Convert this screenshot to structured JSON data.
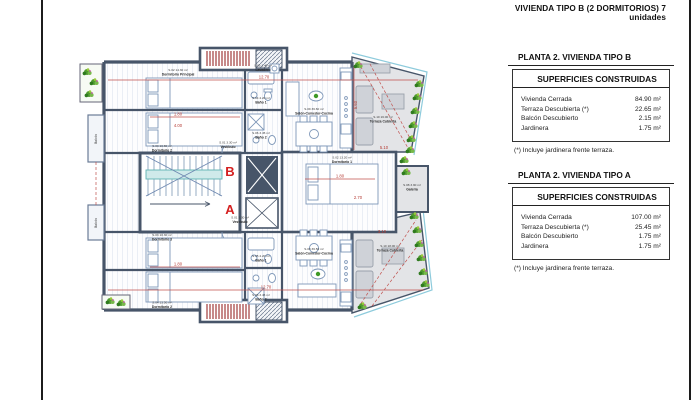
{
  "sheet": {
    "title": "VIVIENDA TIPO B (2 DORMITORIOS) 7 unidades"
  },
  "panels": [
    {
      "heading": "PLANTA 2. VIVIENDA TIPO B",
      "subheading": "SUPERFICIES CONSTRUIDAS",
      "rows": [
        {
          "label": "Vivienda Cerrada",
          "value": "84.90 m²"
        },
        {
          "label": "Terraza Descubierta (*)",
          "value": "22.65 m²"
        },
        {
          "label": "Balcón Descubierto",
          "value": "2.15 m²"
        },
        {
          "label": "Jardinera",
          "value": "1.75 m²"
        }
      ],
      "footnote": "(*) Incluye jardinera frente terraza."
    },
    {
      "heading": "PLANTA 2. VIVIENDA TIPO A",
      "subheading": "SUPERFICIES CONSTRUIDAS",
      "rows": [
        {
          "label": "Vivienda Cerrada",
          "value": "107.00 m²"
        },
        {
          "label": "Terraza Descubierta (*)",
          "value": "25.45 m²"
        },
        {
          "label": "Balcón Descubierto",
          "value": "1.75 m²"
        },
        {
          "label": "Jardinera",
          "value": "1.75 m²"
        }
      ],
      "footnote": "(*) Incluye jardinera frente terraza."
    }
  ],
  "plan": {
    "unit_b_letter": "B",
    "unit_a_letter": "A",
    "rooms": [
      {
        "area": "S.02 14.30 m²",
        "name": "Dormitorio Principal"
      },
      {
        "area": "S.03 10.80 m²",
        "name": "Dormitorio 2"
      },
      {
        "area": "S.05 1.40 m²",
        "name": "Lavadero"
      },
      {
        "area": "S.04 4.20 m²",
        "name": "Baño 1"
      },
      {
        "area": "S.06 3.45 m²",
        "name": "Baño 2"
      },
      {
        "area": "S.01 3.30 m²",
        "name": "Vestíbulo"
      },
      {
        "area": "S.09 36.60 m²",
        "name": "Salón-Comedor-Cocina"
      },
      {
        "area": "S.10 16.00 m²",
        "name": "Terraza Cubierta"
      },
      {
        "area": "S.02 13.20 m²",
        "name": "Dormitorio 1"
      },
      {
        "area": "S.03 10.30 m²",
        "name": "Dormitorio 3"
      },
      {
        "area": "S.04 13.50 m²",
        "name": "Dormitorio 2"
      },
      {
        "area": "S.05 4.20 m²",
        "name": "Baño 1"
      },
      {
        "area": "S.06 3.45 m²",
        "name": "Baño 2"
      },
      {
        "area": "S.01 3.30 m²",
        "name": "Vestíbulo"
      },
      {
        "area": "S.09 36.50 m²",
        "name": "Salón-Comedor-Cocina"
      },
      {
        "area": "S.10 18.00 m²",
        "name": "Terraza Cubierta"
      },
      {
        "area": "S.08 3.90 m²",
        "name": "Galería"
      }
    ],
    "balcony_labels": [
      "Balcón",
      "Balcón"
    ],
    "dimensions": [
      {
        "text": "12.70"
      },
      {
        "text": "12.70"
      },
      {
        "text": "1.80"
      },
      {
        "text": "4.00"
      },
      {
        "text": "1.80"
      },
      {
        "text": "1.80"
      },
      {
        "text": "2.70"
      },
      {
        "text": "5.60"
      },
      {
        "text": "5.10"
      },
      {
        "text": "3.10"
      }
    ]
  },
  "colors": {
    "wall": "#475569",
    "accent_red": "#d42020",
    "dimension_red": "#b43a33",
    "plant_green": "#4e9a2e",
    "terrace_gray": "#e3e4e7",
    "stair_teal": "#5fb3b3"
  }
}
